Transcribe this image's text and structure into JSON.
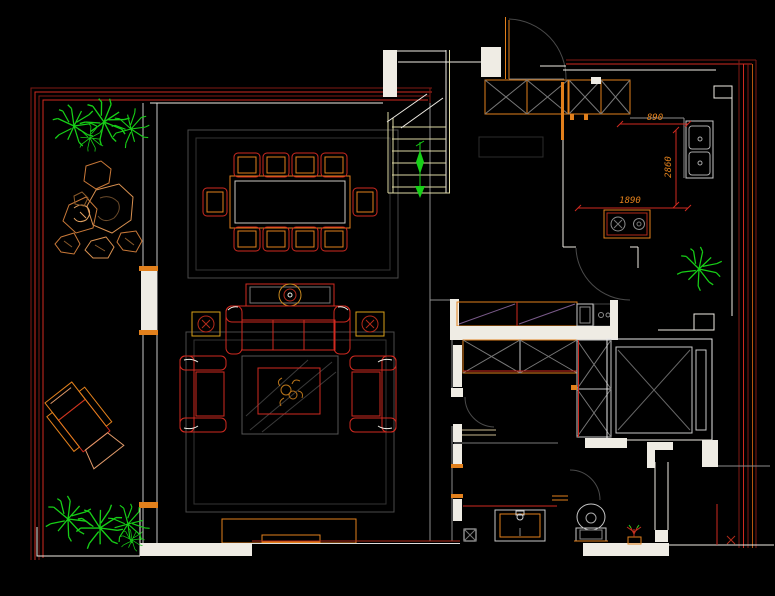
{
  "drawing": {
    "type": "cad-floor-plan",
    "background": "#000000",
    "dimensions": {
      "d890": "890",
      "d2860": "2860",
      "d1890": "1890"
    }
  },
  "palette": {
    "wall_white": "#efece4",
    "wall_line_red": "#cf2a20",
    "wall_line_dark_red": "#7f1a14",
    "furniture_orange": "#e2801c",
    "furniture_red": "#cf2a20",
    "plant_green": "#17cf17",
    "stair_yellow": "#ddd8a4",
    "detail_gray": "#8c8c8c",
    "rug_gray": "#484848",
    "dim_text": "#e2801c"
  },
  "elements": [
    "balcony-garden",
    "rock-garden",
    "lounge-chair",
    "dining-table",
    "dining-chairs",
    "media-console",
    "sofa",
    "coffee-table",
    "armchairs",
    "tv-cabinet",
    "staircase",
    "up-arrow",
    "entry-door",
    "entry-cabinets",
    "kitchen-sink",
    "cooktop",
    "dresser",
    "wardrobes",
    "vanity-sink",
    "toilet",
    "shower-room",
    "direction-arrow",
    "potted-plants"
  ]
}
